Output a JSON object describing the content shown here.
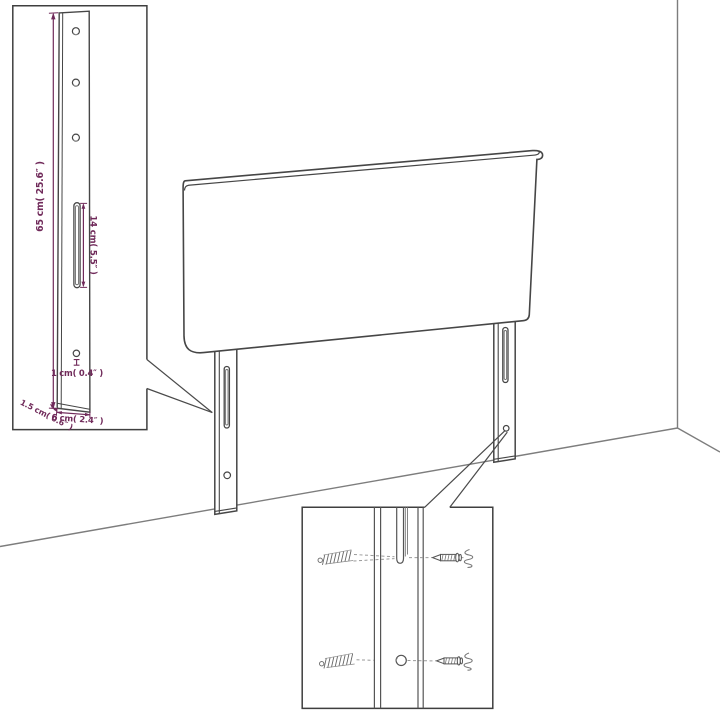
{
  "diagram": {
    "background": "#ffffff",
    "outline_color": "#464646",
    "wall_line_color": "#7d7d7d",
    "hardware_line_color": "#5a5a5a",
    "dimension_color": "#702a5a",
    "post_detail": {
      "height_label": "65 cm( 25.6″ )",
      "slot_label": "14 cm( 5.5″ )",
      "hole_label": "1 cm( 0.4″ )",
      "depth_label": "1.5 cm( 0.6″ )",
      "width_label": "6 cm( 2.4″ )"
    }
  }
}
